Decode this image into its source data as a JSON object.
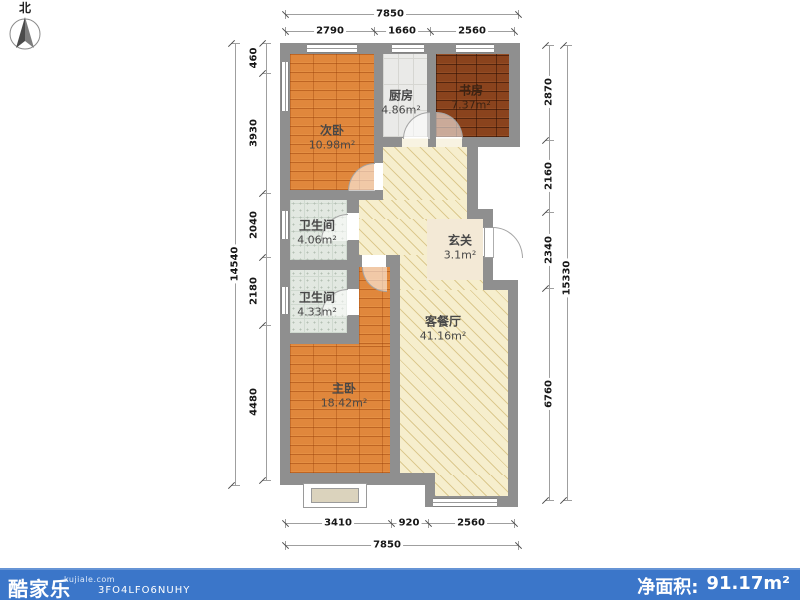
{
  "north": {
    "label": "北"
  },
  "rooms": {
    "ciwo": {
      "name": "次卧",
      "area": "10.98m²"
    },
    "chufang": {
      "name": "厨房",
      "area": "4.86m²"
    },
    "shufang": {
      "name": "书房",
      "area": "7.37m²"
    },
    "wei1": {
      "name": "卫生间",
      "area": "4.06m²"
    },
    "wei2": {
      "name": "卫生间",
      "area": "4.33m²"
    },
    "xuanguan": {
      "name": "玄关",
      "area": "3.1m²"
    },
    "kecanting": {
      "name": "客餐厅",
      "area": "41.16m²"
    },
    "zhuwo": {
      "name": "主卧",
      "area": "18.42m²"
    }
  },
  "dimensions": {
    "top": {
      "total": "7850",
      "segments": [
        "2790",
        "1660",
        "2560"
      ]
    },
    "bottom": {
      "total": "7850",
      "segments": [
        "3410",
        "920",
        "2560"
      ]
    },
    "left": {
      "total": "14540",
      "segments": [
        "460",
        "3930",
        "2040",
        "2180",
        "4480"
      ]
    },
    "right": {
      "total": "15330",
      "segments": [
        "2870",
        "2160",
        "2340",
        "6760"
      ]
    }
  },
  "footer": {
    "brand": "酷家乐",
    "site": "kujiale.com",
    "code": "3FO4LFO6NUHY",
    "net_area_label": "净面积:",
    "net_area_value": "91.17m²"
  },
  "colors": {
    "footer-blue": "#3b76c9",
    "wall": "#8f8f8f",
    "wood": "#e0873c",
    "wood-dark": "#8a431d",
    "tile": "#eaeae8",
    "bath": "#e2e8e1",
    "living": "#f6eecd",
    "living-line": "#dcc98f",
    "entry": "#f3e9d6"
  }
}
